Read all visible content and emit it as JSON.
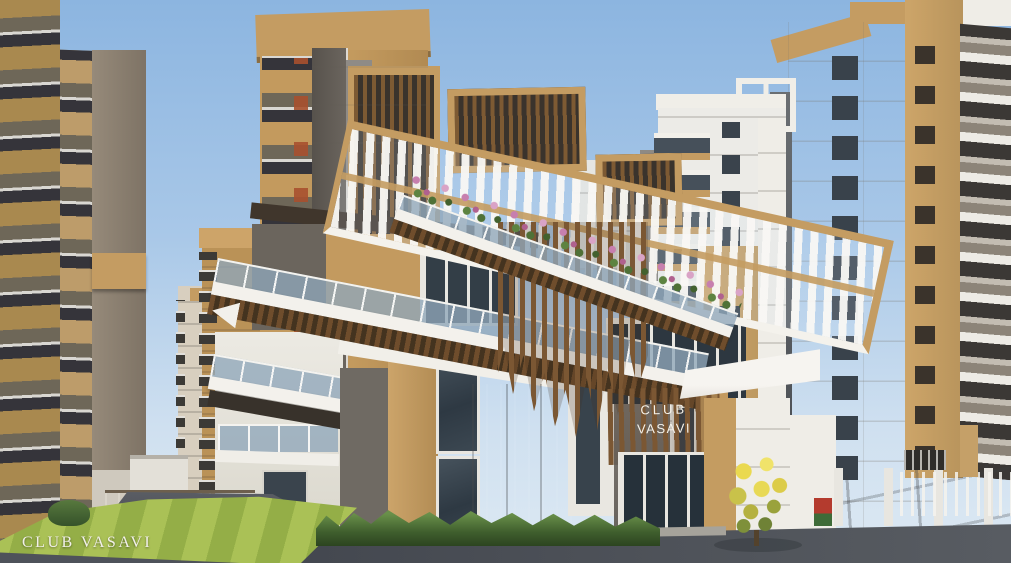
{
  "scene": {
    "caption": "CLUB VASAVI",
    "sign": {
      "line1": "CLUB",
      "line2": "VASAVI"
    }
  },
  "palette": {
    "sky_top": "#8cb5e0",
    "sky_bottom": "#cfe0f0",
    "tan": "#c49c62",
    "tan_dark": "#a9854f",
    "white_wall": "#efede7",
    "gray_wall": "#6f6a63",
    "concrete": "#7d7873",
    "wood": "#74512e",
    "glass": "#31404c",
    "rail_glass": "#8fa6ba",
    "lawn": "#a3bb50",
    "plaza": "#b4b1a9",
    "asphalt": "#474b53",
    "foliage": "#486a33",
    "flower_pink": "#c77fae",
    "flower_yellow": "#e5d54d",
    "accent_red": "#a8502e"
  }
}
